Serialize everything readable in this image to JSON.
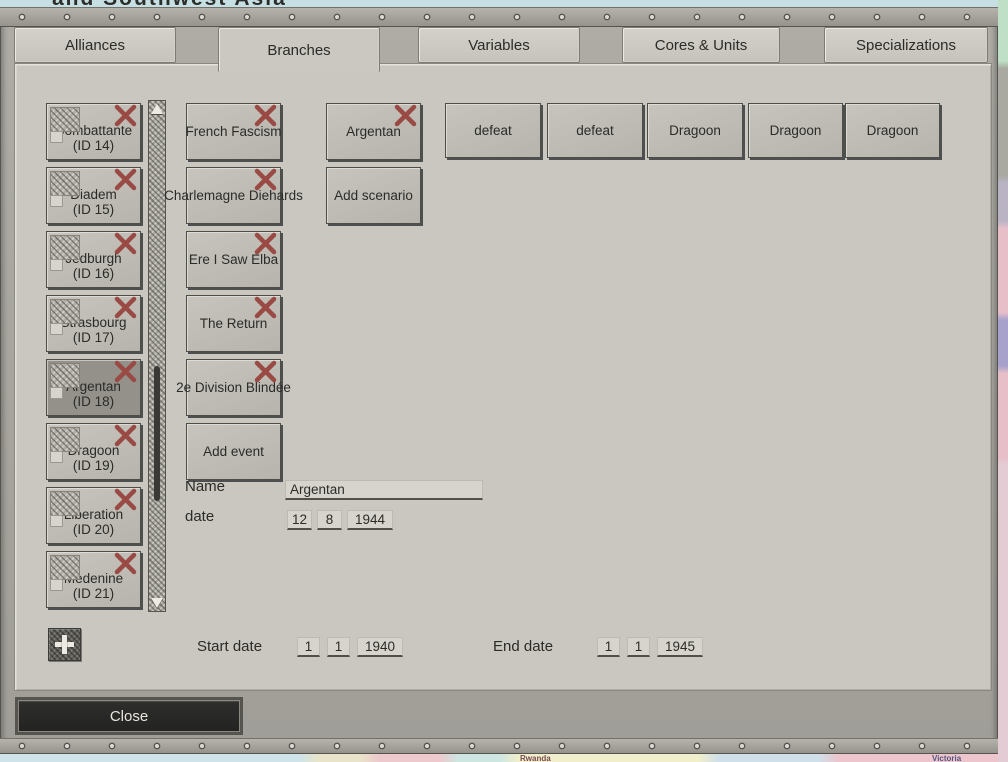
{
  "background": {
    "map_title_fragment": "and Southwest Asia",
    "map_label_rwanda": "Rwanda",
    "map_label_victoria": "Victoria"
  },
  "tabs": [
    {
      "label": "Alliances",
      "selected": false
    },
    {
      "label": "Branches",
      "selected": true
    },
    {
      "label": "Variables",
      "selected": false
    },
    {
      "label": "Cores & Units",
      "selected": false
    },
    {
      "label": "Specializations",
      "selected": false
    }
  ],
  "branch_list": {
    "selected_index": 4,
    "items": [
      {
        "name": "Combattante",
        "id": "(ID 14)"
      },
      {
        "name": "Diadem",
        "id": "(ID 15)"
      },
      {
        "name": "Jedburgh",
        "id": "(ID 16)"
      },
      {
        "name": "Strasbourg",
        "id": "(ID 17)"
      },
      {
        "name": "Argentan",
        "id": "(ID 18)"
      },
      {
        "name": "Dragoon",
        "id": "(ID 19)"
      },
      {
        "name": "Liberation",
        "id": "(ID 20)"
      },
      {
        "name": "Medenine",
        "id": "(ID 21)"
      }
    ]
  },
  "event_buttons": [
    {
      "label": "French Fascism"
    },
    {
      "label": "Charlemagne Diehards"
    },
    {
      "label": "Ere I Saw Elba"
    },
    {
      "label": "The Return"
    },
    {
      "label": "2e Division Blindée"
    }
  ],
  "add_event_label": "Add event",
  "scenario_buttons": [
    {
      "label": "Argentan"
    }
  ],
  "add_scenario_label": "Add scenario",
  "outcome_buttons": [
    {
      "label": "defeat"
    },
    {
      "label": "defeat"
    },
    {
      "label": "Dragoon"
    },
    {
      "label": "Dragoon"
    },
    {
      "label": "Dragoon"
    }
  ],
  "form": {
    "name_label": "Name",
    "name_value": "Argentan",
    "date_label": "date",
    "date_day": "12",
    "date_month": "8",
    "date_year": "1944"
  },
  "footer": {
    "start_date_label": "Start date",
    "start_day": "1",
    "start_month": "1",
    "start_year": "1940",
    "end_date_label": "End date",
    "end_day": "1",
    "end_month": "1",
    "end_year": "1945",
    "close_label": "Close"
  },
  "colors": {
    "delete_x": "#9a4a44",
    "panel_bg": "#c9c7bf",
    "metal_frame": "#a7a59e",
    "button_bg": "#bfbdb5",
    "selected_item_bg": "#93918a",
    "close_button_bg": "#262624",
    "text": "#2b2b28"
  }
}
